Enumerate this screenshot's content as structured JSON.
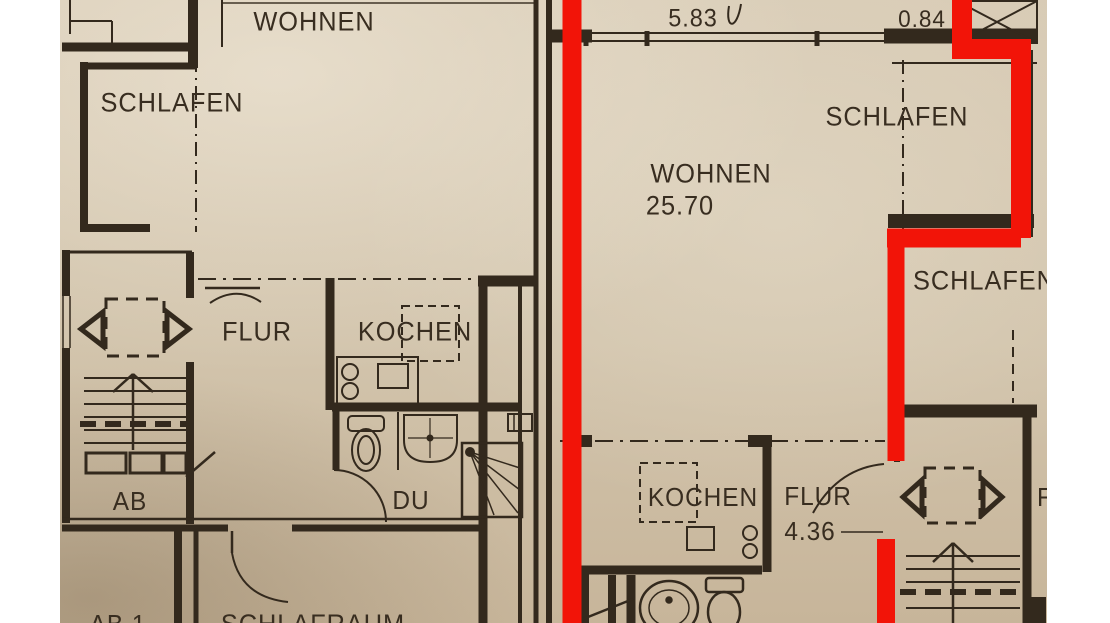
{
  "document": {
    "type": "architectural floor plan photo",
    "language": "German"
  },
  "colors": {
    "paper": "#d2c4ac",
    "ink": "#33291d",
    "highlight_outline": "#f21408",
    "photo_margin": "#ffffff"
  },
  "labels": {
    "left_wohnen": "WOHNEN",
    "left_schlafen": "SCHLAFEN",
    "left_flur": "FLUR",
    "left_kochen": "KOCHEN",
    "left_ab": "AB",
    "left_du": "DU",
    "left_ab1": "AB 1",
    "left_schlafraum": "SCHLAFRAUM",
    "mid_dim_583": "5.83",
    "mid_dim_084": "0.84",
    "mid_wohnen": "WOHNEN",
    "mid_wohnen_area": "25.70",
    "mid_schlafen_top": "SCHLAFEN",
    "mid_kochen": "KOCHEN",
    "mid_flur": "FLUR",
    "mid_flur_area": "4.36",
    "right_schlafen_clipped": "SCHLAFEN",
    "right_flur_clipped": "FLUR"
  },
  "highlight": {
    "meaning": "red outline marking one apartment unit",
    "color": "#f21408"
  }
}
